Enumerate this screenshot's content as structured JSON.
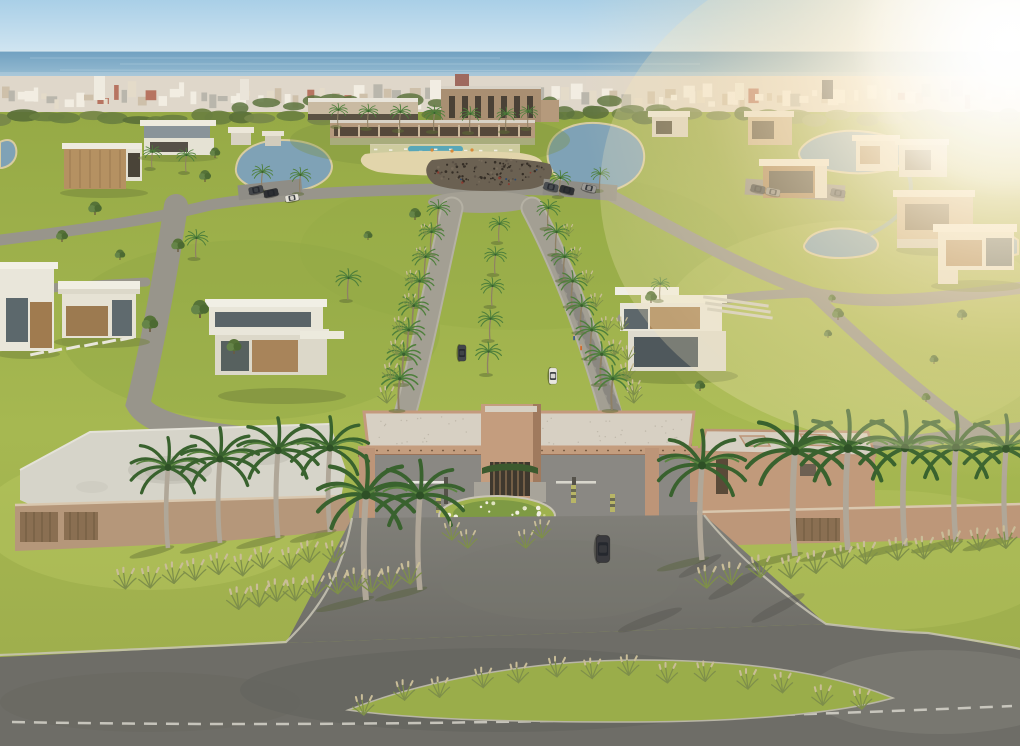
{
  "image": {
    "type": "architectural-aerial-render",
    "subject": "Aerial 3D rendering of a gated residential masterplan community by the sea",
    "visible_text": "none"
  },
  "palette": {
    "sky_top": "#a9cfe7",
    "sky_horizon": "#eaf3f7",
    "ocean_far": "#6f9fc0",
    "ocean_near": "#9cc0d4",
    "city": "#d8cfbf",
    "treeline": "#5f7340",
    "grass_dark": "#96aa46",
    "grass_mid": "#a6b851",
    "grass_light": "#bac95e",
    "asphalt": "#6e6d67",
    "asphalt_light": "#807f78",
    "paver_street": "#98958b",
    "boulevard_paver": "#a39f93",
    "gate_tan": "#c49d7e",
    "gate_tan_dark": "#a07a5e",
    "roof_gravel": "#d7d0c3",
    "wood_slat": "#8a6f52",
    "house_white": "#e9e6da",
    "house_wood": "#a8845a",
    "glass_dark": "#5c666a",
    "lake": "#7fa2b6",
    "sand": "#e2d5ab",
    "palm_green": "#4e7f3b",
    "palm_dark": "#39602f",
    "royal_trunk": "#b0a798",
    "plume_tan": "#c3b795",
    "concrete": "#d6d4c9",
    "sun_glow": "#fff3dc",
    "car_dark": "#3a3a3e",
    "lane_line": "#d6d4ca"
  },
  "scene": {
    "elements": [
      {
        "name": "sky",
        "desc": "clear pale blue sky"
      },
      {
        "name": "ocean-horizon",
        "desc": "sea band behind coastal city"
      },
      {
        "name": "city-skyline",
        "desc": "distant low-rise coastal city strip"
      },
      {
        "name": "sun-glare",
        "desc": "strong warm sun flare upper right"
      },
      {
        "name": "clubhouse-complex",
        "desc": "tan clubhouse with pool, beach and lagoon"
      },
      {
        "name": "lagoon",
        "desc": "curved lakes with sandy edges"
      },
      {
        "name": "palm-boulevard",
        "desc": "double paver boulevard lined with palms"
      },
      {
        "name": "entrance-gate",
        "desc": "tan portal canopy with guard barriers"
      },
      {
        "name": "roundabout-island",
        "desc": "planted flower island at gate"
      },
      {
        "name": "gatehouse",
        "desc": "tan flat-roof gatehouse right of portal"
      },
      {
        "name": "perimeter-wall",
        "desc": "tan walls with wood slats and royal palms"
      },
      {
        "name": "skatepark",
        "desc": "concrete skate bowl area left of gate"
      },
      {
        "name": "villas",
        "desc": "modern white and wood flat-roof houses"
      },
      {
        "name": "access-road",
        "desc": "asphalt approach road and avenue with grass median"
      },
      {
        "name": "vehicles",
        "desc": "cars on boulevard, parking lots and approach"
      }
    ]
  }
}
